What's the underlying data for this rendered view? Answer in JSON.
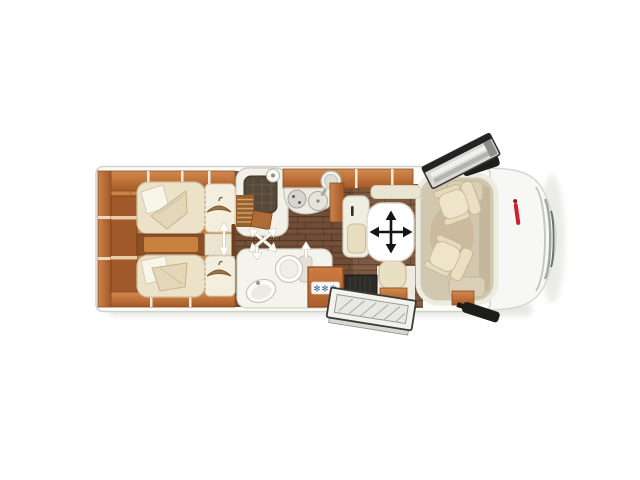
{
  "meta": {
    "title": "Motorhome floor plan — top view",
    "diagram_type": "vehicle-floorplan"
  },
  "canvas": {
    "width": 640,
    "height": 480,
    "background": "#ffffff"
  },
  "vehicle": {
    "body_fill": "#fcfcf9",
    "body_outline": "#d2d2cb",
    "cab_fill": "#f7f8f6",
    "mirror_color": "#1d1d1b",
    "logo_color": "#c8232e"
  },
  "floors": {
    "rear_bedroom_wood": "#cc8148",
    "corridor_wood": "#6e4c36",
    "dinette_wood": "#7a5740",
    "cab_floor": "#d2c8b0"
  },
  "rooms": {
    "rear_bedroom": {
      "name": "rear twin single beds",
      "beds": 2,
      "wardrobe_hanger_icons": 2
    },
    "shower": {
      "name": "shower cubicle"
    },
    "toilet_room": {
      "name": "washroom with toilet and basin"
    },
    "kitchen": {
      "name": "kitchen block with hob and sink"
    },
    "fridge": {
      "badge": "✻✻✻",
      "badge_color": "#3a5fa4",
      "front_color": "#c9743c"
    },
    "dinette": {
      "name": "half dinette with movable table",
      "table_symbol": "four-way-arrows"
    },
    "cab": {
      "name": "driver cab",
      "seats": [
        "driver swivel seat",
        "passenger swivel seat"
      ]
    },
    "entrance": {
      "name": "entry step with open door"
    }
  },
  "symbols": {
    "table_arrows": "table adjustable in all directions",
    "door_arrows": "sliding / swivel door movement",
    "open_doors": 2
  }
}
